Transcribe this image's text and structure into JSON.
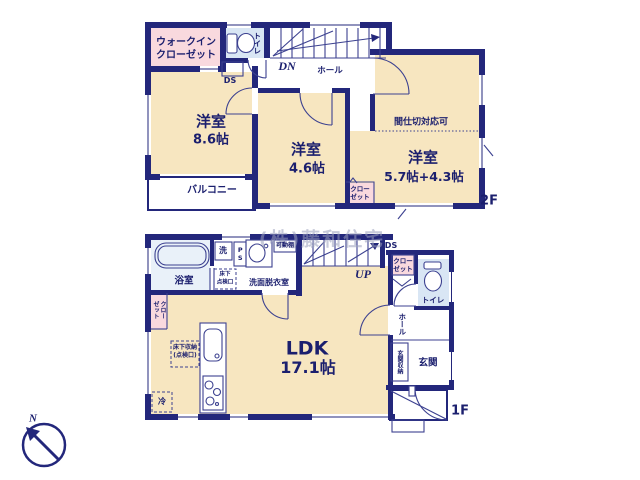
{
  "floor2": {
    "floor_label": "2F",
    "walk_in_closet": {
      "line1": "ウォークイン",
      "line2": "クローゼット"
    },
    "toilet": "トイレ",
    "duct": "DS",
    "stairs_down": "DN",
    "hall": "ホール",
    "room_a": {
      "name": "洋室",
      "size": "8.6帖"
    },
    "balcony": "バルコニー",
    "room_b": {
      "name": "洋室",
      "size": "4.6帖"
    },
    "room_c": {
      "name": "洋室",
      "size": "5.7帖+4.3帖",
      "note": "間仕切対応可"
    },
    "closet": {
      "line1": "クロー",
      "line2": "ゼット"
    }
  },
  "floor1": {
    "floor_label": "1F",
    "bathroom": "浴室",
    "washer": "洗",
    "pipe_space": "PS",
    "underfloor_hatch": {
      "line1": "床下",
      "line2": "点検口"
    },
    "washroom": "洗面脱衣室",
    "movable_shelf": "可動棚",
    "duct": "DS",
    "stairs_up": "UP",
    "hall_closet": {
      "line1": "クロー",
      "line2": "ゼット"
    },
    "left_closet": {
      "line1": "クロー",
      "line2": "ゼット"
    },
    "toilet": "トイレ",
    "hall": "ホール",
    "entrance_storage": "玄関収納",
    "entrance": "玄関",
    "underfloor_storage": {
      "line1": "床下収納",
      "line2": "(点検口)"
    },
    "refrigerator": "冷",
    "ldk": {
      "name": "LDK",
      "size": "17.1帖"
    }
  },
  "compass": {
    "north": "N"
  },
  "watermark": "(株)藤和住宅",
  "colors": {
    "wall": "#23277b",
    "room": "#f7e6c0",
    "closet_pink": "#f9d9de",
    "water_blue": "#d9e6f4",
    "bath_blue": "#e9f1f9",
    "line": "#3c4190",
    "text": "#1b1f6e",
    "watermark": "#9ba0bd"
  }
}
